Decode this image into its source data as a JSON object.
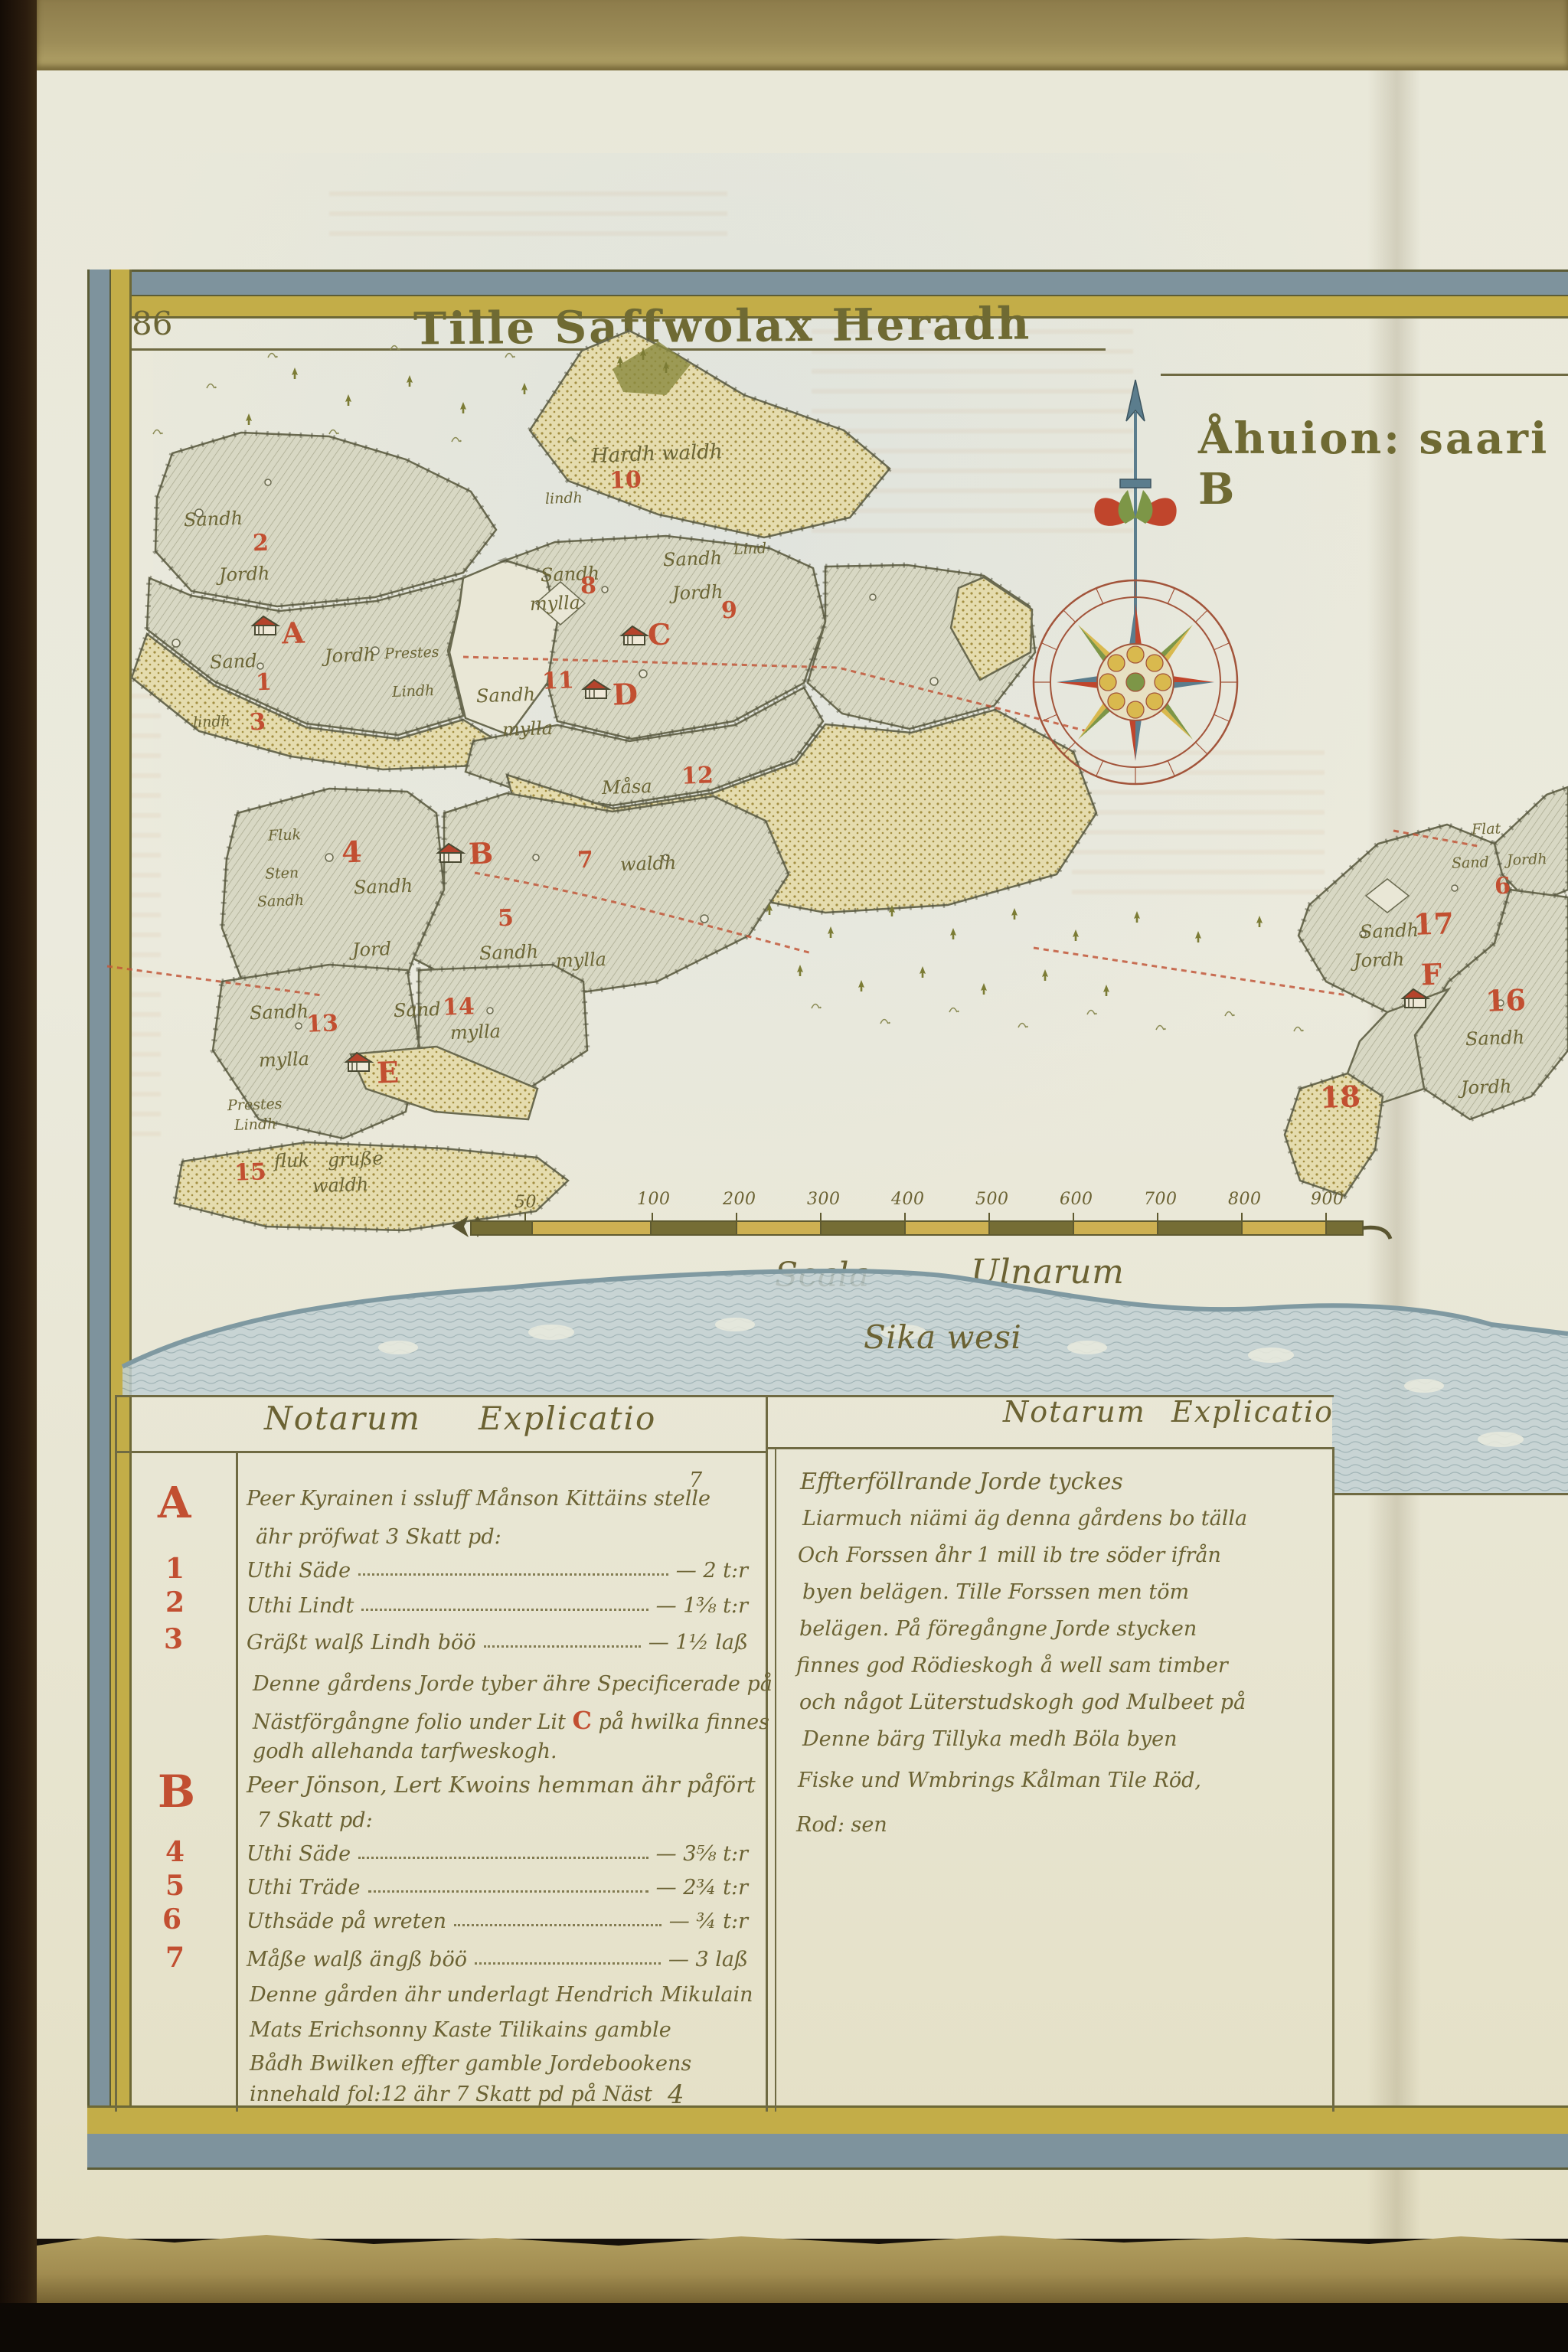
{
  "page": {
    "number": "86",
    "title": "Tille Saffwolax Heradh",
    "title_right": "Åhuion: saari B",
    "water_label": "Sika wesi"
  },
  "scale_bar": {
    "caption": "Scala",
    "caption2": "Ulnarum",
    "ticks": [
      "50",
      "100",
      "200",
      "300",
      "400",
      "500",
      "600",
      "700",
      "800",
      "900"
    ]
  },
  "map": {
    "labels": [
      "Sandh",
      "2",
      "Jordh",
      "lindh",
      "Sand",
      "A",
      "Jordh",
      "1",
      "3",
      "lindh",
      "Prestes",
      "Lindh",
      "Sandh",
      "mylla",
      "8",
      "Sandh",
      "Jordh",
      "9",
      "Lind",
      "C",
      "Hardh waldh",
      "10",
      "Sandh",
      "mylla",
      "11",
      "D",
      "Måsa",
      "12",
      "7",
      "waldh",
      "Fluk",
      "Sten",
      "Sandh",
      "4",
      "Sandh",
      "Jord",
      "B",
      "5",
      "Sandh",
      "mylla",
      "Sandh",
      "13",
      "mylla",
      "Sand",
      "14",
      "mylla",
      "E",
      "Prestes",
      "Lindh",
      "15",
      "fluk",
      "gruße",
      "waldh",
      "Flat",
      "Sand",
      "Jordh",
      "6",
      "Sandh",
      "17",
      "Jordh",
      "F",
      "16",
      "Sandh",
      "Jordh",
      "18"
    ]
  },
  "table": {
    "header_left": {
      "word1": "Notarum",
      "word2": "Explicatio"
    },
    "header_right": {
      "word1": "Notarum",
      "word2": "Explicatio"
    },
    "left": {
      "section_a": {
        "letter": "A",
        "mark": "7",
        "line1": "Peer Kyrainen i ssluff Månson Kittäins stelle",
        "line2": "ähr pröfwat 3 Skatt pd:",
        "rows": [
          {
            "num": "1",
            "label": "Uthi Säde",
            "value": "— 2",
            "unit": "t:r"
          },
          {
            "num": "2",
            "label": "Uthi Lindt",
            "value": "— 1⅜",
            "unit": "t:r"
          },
          {
            "num": "3",
            "label": "Gräßt walß Lindh böö",
            "value": "— 1½",
            "unit": "laß"
          }
        ],
        "note1": "Denne gårdens Jorde tyber ähre Specificerade på",
        "note2a": "Nästförgångne folio under Lit",
        "note2b": "C",
        "note2c": "på hwilka finnes",
        "note3": "godh allehanda tarfweskogh."
      },
      "section_b": {
        "letter": "B",
        "line1": "Peer Jönson, Lert Kwoins hemman ähr påfört",
        "line2": "7 Skatt pd:",
        "rows": [
          {
            "num": "4",
            "label": "Uthi Säde",
            "value": "— 3⅝",
            "unit": "t:r"
          },
          {
            "num": "5",
            "label": "Uthi Träde",
            "value": "— 2¾",
            "unit": "t:r"
          },
          {
            "num": "6",
            "label": "Uthsäde på wreten",
            "value": "— ¾",
            "unit": "t:r"
          },
          {
            "num": "7",
            "label": "Måße walß ängß böö",
            "value": "— 3",
            "unit": "laß"
          }
        ],
        "note1": "Denne gården ähr underlagt Hendrich Mikulain",
        "note2": "Mats Erichsonny Kaste Tilikains gamble",
        "note3": "Bådh Bwilken effter gamble Jordebookens",
        "note4": "innehald fol:12 ähr 7 Skatt pd på Näst",
        "mark": "4"
      }
    },
    "right": {
      "lines": [
        "Effterföllrande Jorde tyckes",
        "Liarmuch niämi äg denna gårdens bo tälla",
        "Och Forssen åhr 1 mill ib tre söder ifrån",
        "byen belägen. Tille Forssen men töm",
        "belägen. På föregångne Jorde stycken",
        "finnes god Rödieskogh å well sam timber",
        "och något Lüterstudskogh god Mulbeet på",
        "Denne bärg Tillyka medh Böla byen",
        "Fiske und Wmbrings Kålman Tile Röd,",
        "Rod: sen"
      ]
    }
  }
}
